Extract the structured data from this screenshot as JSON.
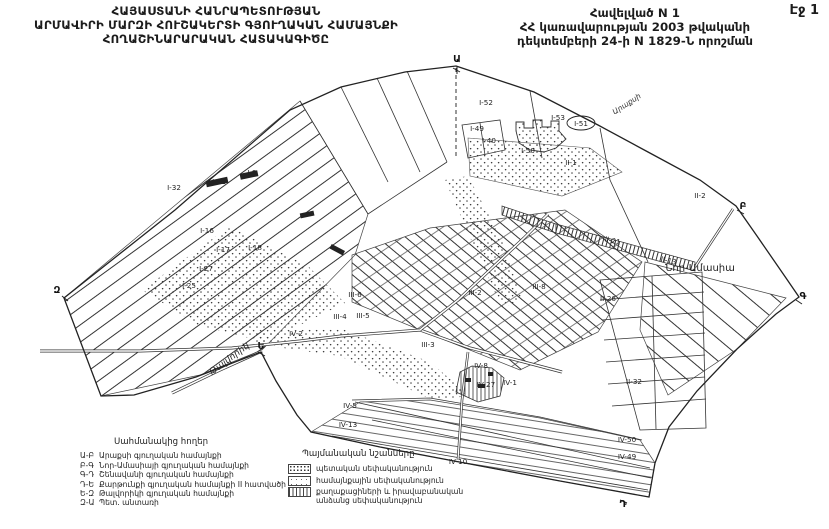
{
  "page": {
    "number": "Էջ 1"
  },
  "header": {
    "left": [
      "ՀԱՅԱՍՏԱՆԻ ՀԱՆՐԱՊԵՏՈՒԹՅԱՆ",
      "ԱՐՄԱՎԻՐԻ ՄԱՐԶԻ ՀՈՒՇԱԿԵՐՏԻ ԳՅՈՒՂԱԿԱՆ ՀԱՄԱՅՆՔԻ",
      "ՀՈՂԱՇԻՆԱՐԱՐԱԿԱՆ ՀԱՏԱԿԱԳԻԾԸ"
    ],
    "right": [
      "Հավելված N 1",
      "ՀՀ կառավարության 2003 թվականի",
      "դեկտեմբերի 24-ի N 1829-Ն որոշման"
    ]
  },
  "map": {
    "parcel_labels": [
      {
        "t": "I-9",
        "x": 252,
        "y": 175
      },
      {
        "t": "I-11",
        "x": 219,
        "y": 184
      },
      {
        "t": "I-32",
        "x": 174,
        "y": 190
      },
      {
        "t": "I-16",
        "x": 207,
        "y": 233
      },
      {
        "t": "I-17",
        "x": 223,
        "y": 252
      },
      {
        "t": "I-18",
        "x": 255,
        "y": 250
      },
      {
        "t": "I-27",
        "x": 206,
        "y": 271
      },
      {
        "t": "I-25",
        "x": 189,
        "y": 288
      },
      {
        "t": "I-49",
        "x": 477,
        "y": 131
      },
      {
        "t": "I-40",
        "x": 489,
        "y": 143
      },
      {
        "t": "I-52",
        "x": 486,
        "y": 105
      },
      {
        "t": "I-53",
        "x": 558,
        "y": 120
      },
      {
        "t": "I-51",
        "x": 581,
        "y": 126
      },
      {
        "t": "I-50",
        "x": 528,
        "y": 153
      },
      {
        "t": "II-1",
        "x": 571,
        "y": 165
      },
      {
        "t": "II-2",
        "x": 700,
        "y": 198
      },
      {
        "t": "II-21",
        "x": 612,
        "y": 243,
        "r": 13
      },
      {
        "t": "II-13",
        "x": 668,
        "y": 263,
        "r": 13
      },
      {
        "t": "II-26",
        "x": 608,
        "y": 301
      },
      {
        "t": "II-32",
        "x": 634,
        "y": 384
      },
      {
        "t": "III-6",
        "x": 355,
        "y": 297
      },
      {
        "t": "III-4",
        "x": 340,
        "y": 319
      },
      {
        "t": "III-5",
        "x": 363,
        "y": 318
      },
      {
        "t": "III-2",
        "x": 475,
        "y": 295
      },
      {
        "t": "III-8",
        "x": 539,
        "y": 289
      },
      {
        "t": "III-3",
        "x": 428,
        "y": 347
      },
      {
        "t": "IV-2",
        "x": 296,
        "y": 336
      },
      {
        "t": "IV-5",
        "x": 350,
        "y": 408
      },
      {
        "t": "IV-13",
        "x": 348,
        "y": 427
      },
      {
        "t": "IV-8",
        "x": 481,
        "y": 368
      },
      {
        "t": "IV-27",
        "x": 486,
        "y": 387
      },
      {
        "t": "IV-1",
        "x": 510,
        "y": 385
      },
      {
        "t": "IV-10",
        "x": 458,
        "y": 464
      },
      {
        "t": "IV-50",
        "x": 627,
        "y": 442
      },
      {
        "t": "IV-49",
        "x": 627,
        "y": 459
      }
    ],
    "place_labels": [
      {
        "t": "Նոր-Ամասիա",
        "x": 700,
        "y": 271,
        "cls": "place"
      },
      {
        "t": "Թալվորիկ",
        "x": 231,
        "y": 361,
        "r": -37,
        "cls": "place-it"
      },
      {
        "t": "Արաքսի",
        "x": 628,
        "y": 106,
        "r": -33,
        "cls": "place-sm"
      }
    ],
    "corner_letters": [
      {
        "t": "Ա",
        "x": 457,
        "y": 62
      },
      {
        "t": "Բ",
        "x": 743,
        "y": 209
      },
      {
        "t": "Գ",
        "x": 803,
        "y": 299
      },
      {
        "t": "Դ",
        "x": 623,
        "y": 507
      },
      {
        "t": "Ե",
        "x": 261,
        "y": 349
      },
      {
        "t": "Զ",
        "x": 57,
        "y": 293
      }
    ]
  },
  "legend_borders": {
    "title": "Սահմանակից հողեր",
    "items": [
      {
        "code": "Ա-Բ",
        "label": "Արաքսի գյուղական համայնքի"
      },
      {
        "code": "Բ-Գ",
        "label": "Նոր-Ամասիայի գյուղական համայնքի"
      },
      {
        "code": "Գ-Դ",
        "label": "Շենավանի գյուղական համայնքի"
      },
      {
        "code": "Դ-Ե",
        "label": "Քարթունքի գյուղական համայնքի II հատվածի"
      },
      {
        "code": "Ե-Զ",
        "label": "Թալվորիկի գյուղական համայնքի"
      },
      {
        "code": "Զ-Ա",
        "label": "Պետ. անտառի"
      }
    ]
  },
  "legend_symbols": {
    "title": "Պայմանական նշանները",
    "items": [
      {
        "pattern": "dots",
        "label": "պետական սեփականություն"
      },
      {
        "pattern": "sparse",
        "label": "համայնքային սեփականություն"
      },
      {
        "pattern": "vlines",
        "label": "քաղաքացիների և իրավաբանական անձանց սեփականություն"
      }
    ]
  },
  "colors": {
    "ink": "#222222",
    "paper": "#ffffff"
  }
}
